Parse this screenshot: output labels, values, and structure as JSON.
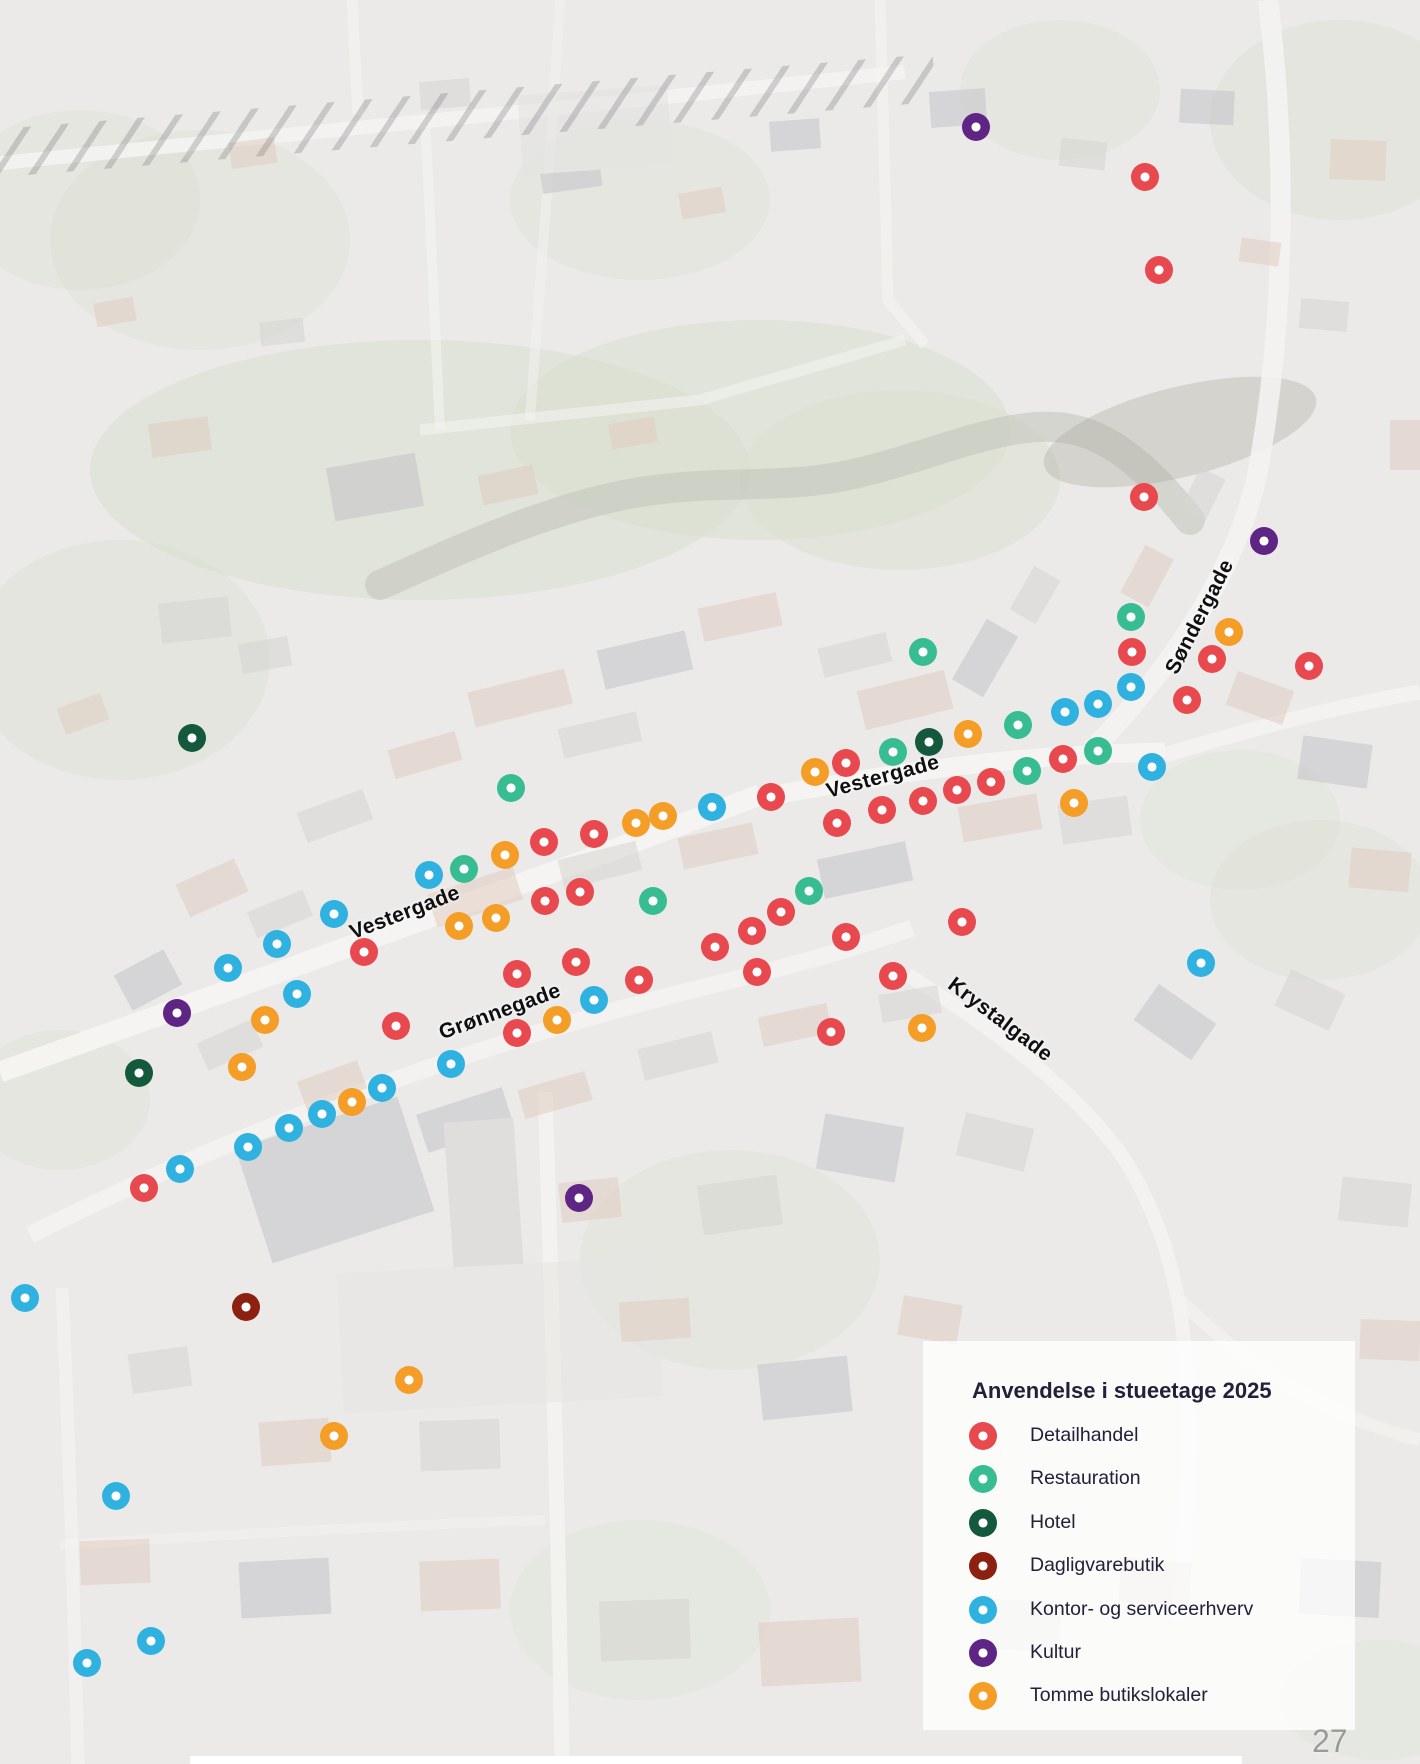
{
  "page_number": "27",
  "legend": {
    "title": "Anvendelse i stueetage 2025",
    "items": [
      {
        "key": "detailhandel",
        "label": "Detailhandel",
        "color": "#e8494e"
      },
      {
        "key": "restauration",
        "label": "Restauration",
        "color": "#38bd92"
      },
      {
        "key": "hotel",
        "label": "Hotel",
        "color": "#15593d"
      },
      {
        "key": "dagligvarebutik",
        "label": "Dagligvarebutik",
        "color": "#8c2011"
      },
      {
        "key": "kontor",
        "label": "Kontor- og serviceerhverv",
        "color": "#30b2e1"
      },
      {
        "key": "kultur",
        "label": "Kultur",
        "color": "#5e2585"
      },
      {
        "key": "tomme",
        "label": "Tomme butikslokaler",
        "color": "#f49d27"
      }
    ]
  },
  "street_labels": [
    {
      "text": "Vestergade",
      "x": 405,
      "y": 913,
      "rotation": -21
    },
    {
      "text": "Vestergade",
      "x": 883,
      "y": 777,
      "rotation": -15
    },
    {
      "text": "Søndergade",
      "x": 1200,
      "y": 617,
      "rotation": -63
    },
    {
      "text": "Grønnegade",
      "x": 500,
      "y": 1012,
      "rotation": -20
    },
    {
      "text": "Krystalgade",
      "x": 1000,
      "y": 1020,
      "rotation": 37
    }
  ],
  "map_points": [
    {
      "k": "kultur",
      "x": 976,
      "y": 127
    },
    {
      "k": "kultur",
      "x": 1264,
      "y": 541
    },
    {
      "k": "kultur",
      "x": 177,
      "y": 1013
    },
    {
      "k": "kultur",
      "x": 579,
      "y": 1198
    },
    {
      "k": "detailhandel",
      "x": 1145,
      "y": 177
    },
    {
      "k": "detailhandel",
      "x": 1159,
      "y": 270
    },
    {
      "k": "detailhandel",
      "x": 1144,
      "y": 497
    },
    {
      "k": "detailhandel",
      "x": 1132,
      "y": 652
    },
    {
      "k": "detailhandel",
      "x": 1212,
      "y": 659
    },
    {
      "k": "detailhandel",
      "x": 1309,
      "y": 666
    },
    {
      "k": "detailhandel",
      "x": 1187,
      "y": 700
    },
    {
      "k": "detailhandel",
      "x": 1063,
      "y": 759
    },
    {
      "k": "detailhandel",
      "x": 991,
      "y": 782
    },
    {
      "k": "detailhandel",
      "x": 957,
      "y": 790
    },
    {
      "k": "detailhandel",
      "x": 923,
      "y": 801
    },
    {
      "k": "detailhandel",
      "x": 882,
      "y": 810
    },
    {
      "k": "detailhandel",
      "x": 846,
      "y": 763
    },
    {
      "k": "detailhandel",
      "x": 837,
      "y": 823
    },
    {
      "k": "detailhandel",
      "x": 771,
      "y": 797
    },
    {
      "k": "detailhandel",
      "x": 594,
      "y": 834
    },
    {
      "k": "detailhandel",
      "x": 544,
      "y": 842
    },
    {
      "k": "detailhandel",
      "x": 580,
      "y": 892
    },
    {
      "k": "detailhandel",
      "x": 545,
      "y": 901
    },
    {
      "k": "detailhandel",
      "x": 364,
      "y": 952
    },
    {
      "k": "detailhandel",
      "x": 576,
      "y": 962
    },
    {
      "k": "detailhandel",
      "x": 517,
      "y": 974
    },
    {
      "k": "detailhandel",
      "x": 639,
      "y": 980
    },
    {
      "k": "detailhandel",
      "x": 396,
      "y": 1026
    },
    {
      "k": "detailhandel",
      "x": 517,
      "y": 1033
    },
    {
      "k": "detailhandel",
      "x": 144,
      "y": 1188
    },
    {
      "k": "detailhandel",
      "x": 781,
      "y": 912
    },
    {
      "k": "detailhandel",
      "x": 752,
      "y": 931
    },
    {
      "k": "detailhandel",
      "x": 715,
      "y": 947
    },
    {
      "k": "detailhandel",
      "x": 757,
      "y": 972
    },
    {
      "k": "detailhandel",
      "x": 846,
      "y": 937
    },
    {
      "k": "detailhandel",
      "x": 893,
      "y": 976
    },
    {
      "k": "detailhandel",
      "x": 962,
      "y": 922
    },
    {
      "k": "detailhandel",
      "x": 831,
      "y": 1032
    },
    {
      "k": "restauration",
      "x": 923,
      "y": 652
    },
    {
      "k": "restauration",
      "x": 1131,
      "y": 617
    },
    {
      "k": "restauration",
      "x": 1018,
      "y": 725
    },
    {
      "k": "restauration",
      "x": 1098,
      "y": 751
    },
    {
      "k": "restauration",
      "x": 1027,
      "y": 771
    },
    {
      "k": "restauration",
      "x": 893,
      "y": 752
    },
    {
      "k": "restauration",
      "x": 511,
      "y": 788
    },
    {
      "k": "restauration",
      "x": 464,
      "y": 869
    },
    {
      "k": "restauration",
      "x": 653,
      "y": 901
    },
    {
      "k": "restauration",
      "x": 809,
      "y": 891
    },
    {
      "k": "hotel",
      "x": 192,
      "y": 738
    },
    {
      "k": "hotel",
      "x": 929,
      "y": 742
    },
    {
      "k": "hotel",
      "x": 139,
      "y": 1073
    },
    {
      "k": "dagligvarebutik",
      "x": 246,
      "y": 1307
    },
    {
      "k": "kontor",
      "x": 1131,
      "y": 687
    },
    {
      "k": "kontor",
      "x": 1098,
      "y": 704
    },
    {
      "k": "kontor",
      "x": 1065,
      "y": 712
    },
    {
      "k": "kontor",
      "x": 1152,
      "y": 767
    },
    {
      "k": "kontor",
      "x": 1201,
      "y": 963
    },
    {
      "k": "kontor",
      "x": 712,
      "y": 807
    },
    {
      "k": "kontor",
      "x": 429,
      "y": 875
    },
    {
      "k": "kontor",
      "x": 334,
      "y": 914
    },
    {
      "k": "kontor",
      "x": 277,
      "y": 944
    },
    {
      "k": "kontor",
      "x": 228,
      "y": 968
    },
    {
      "k": "kontor",
      "x": 297,
      "y": 994
    },
    {
      "k": "kontor",
      "x": 594,
      "y": 1000
    },
    {
      "k": "kontor",
      "x": 451,
      "y": 1064
    },
    {
      "k": "kontor",
      "x": 382,
      "y": 1088
    },
    {
      "k": "kontor",
      "x": 322,
      "y": 1114
    },
    {
      "k": "kontor",
      "x": 289,
      "y": 1128
    },
    {
      "k": "kontor",
      "x": 248,
      "y": 1147
    },
    {
      "k": "kontor",
      "x": 180,
      "y": 1169
    },
    {
      "k": "kontor",
      "x": 25,
      "y": 1298
    },
    {
      "k": "kontor",
      "x": 116,
      "y": 1496
    },
    {
      "k": "kontor",
      "x": 151,
      "y": 1641
    },
    {
      "k": "kontor",
      "x": 87,
      "y": 1663
    },
    {
      "k": "tomme",
      "x": 1229,
      "y": 632
    },
    {
      "k": "tomme",
      "x": 968,
      "y": 734
    },
    {
      "k": "tomme",
      "x": 1074,
      "y": 803
    },
    {
      "k": "tomme",
      "x": 815,
      "y": 772
    },
    {
      "k": "tomme",
      "x": 663,
      "y": 816
    },
    {
      "k": "tomme",
      "x": 636,
      "y": 823
    },
    {
      "k": "tomme",
      "x": 505,
      "y": 855
    },
    {
      "k": "tomme",
      "x": 496,
      "y": 918
    },
    {
      "k": "tomme",
      "x": 459,
      "y": 926
    },
    {
      "k": "tomme",
      "x": 557,
      "y": 1020
    },
    {
      "k": "tomme",
      "x": 265,
      "y": 1020
    },
    {
      "k": "tomme",
      "x": 242,
      "y": 1067
    },
    {
      "k": "tomme",
      "x": 352,
      "y": 1102
    },
    {
      "k": "tomme",
      "x": 922,
      "y": 1028
    },
    {
      "k": "tomme",
      "x": 409,
      "y": 1380
    },
    {
      "k": "tomme",
      "x": 334,
      "y": 1436
    }
  ]
}
